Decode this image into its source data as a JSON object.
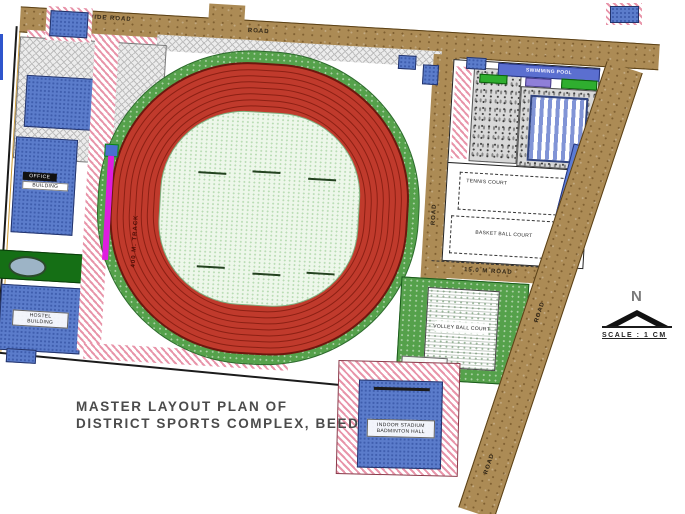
{
  "title": {
    "line1": "MASTER LAYOUT PLAN OF",
    "line2": "DISTRICT SPORTS COMPLEX, BEED"
  },
  "compass": {
    "north_letter": "N",
    "scale_text": "SCALE : 1 CM"
  },
  "labels": {
    "road_top_a": "60.00 M WIDE ROAD",
    "road_top_b": "ROAD",
    "road_inner": "ROAD",
    "road_middle": "15.0 M ROAD",
    "road_east_a": "ROAD",
    "road_east_b": "ROAD",
    "road_proposed": "PROPOSED ROAD",
    "track": "400 M. TRACK",
    "swimming_pool": "SWIMMING POOL",
    "court_1": "TENNIS COURT",
    "court_2": "BASKET BALL COURT",
    "play_ground": "VOLLEY BALL COURT",
    "play_ground_2": "KHO-KHO",
    "building_office_1": "OFFICE",
    "building_office_2": "BUILDING",
    "building_hostel_1": "HOSTEL",
    "building_hostel_2": "BUILDING",
    "indoor_1": "INDOOR STADIUM",
    "indoor_2": "BADMINTON HALL"
  },
  "colors": {
    "road_brown": "#AC8B55",
    "track_red": "#C03A2C",
    "track_line": "#8C2014",
    "infield_green": "#EDF7EA",
    "surround_green": "#55A14B",
    "building_blue": "#5B7CCB",
    "hatch_pink": "#E895AA",
    "pool_blue": "#8194D6",
    "magenta": "#DF1DDF",
    "dark_green": "#156F15",
    "strip_blue": "#5B7BD5"
  }
}
